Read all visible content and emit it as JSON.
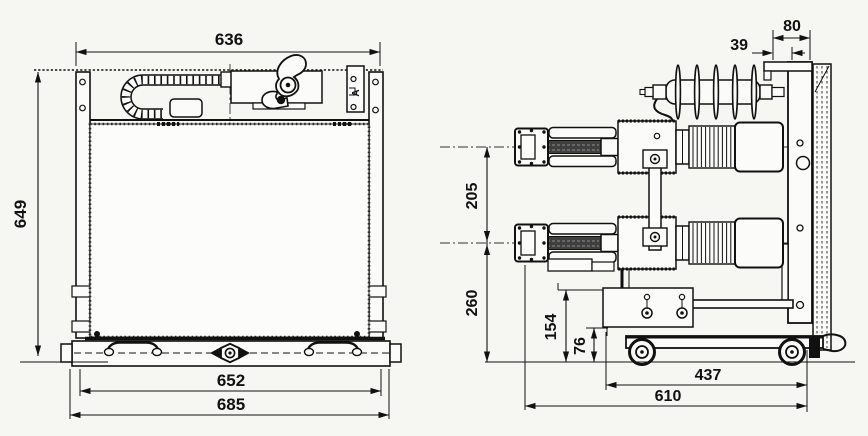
{
  "front_view": {
    "dim_top_width": "636",
    "dim_height": "649",
    "dim_base_width": "652",
    "dim_overall_width": "685",
    "bracket_label": "A"
  },
  "side_view": {
    "dim_top_depth": "80",
    "dim_top_offset": "39",
    "dim_pole_spacing": "205",
    "dim_lower_pole_height": "260",
    "dim_bracket_height": "154",
    "dim_beam_height": "76",
    "dim_wheelbase": "437",
    "dim_overall_depth": "610"
  }
}
